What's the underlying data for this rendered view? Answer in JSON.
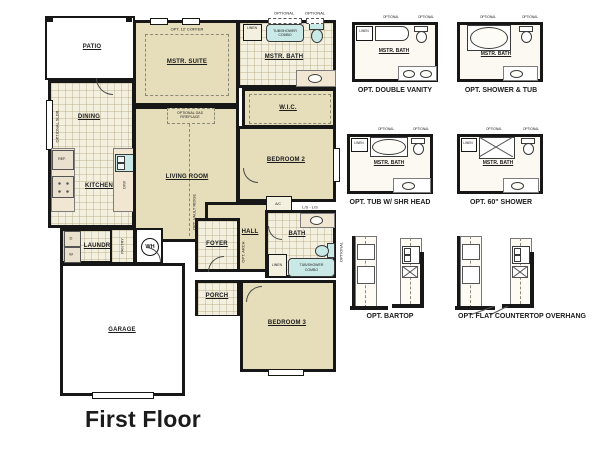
{
  "title": "First Floor",
  "colors": {
    "wall": "#171717",
    "room_beige": "#e6ddbb",
    "tile_cream": "#f4f0df",
    "fixture_blue": "#c9e9e7",
    "background": "#ffffff"
  },
  "plan": {
    "patio": "PATIO",
    "mstr_suite": "MSTR. SUITE",
    "coffer": "OPT. 12' COFFER",
    "mstr_bath": "MSTR. BATH",
    "tub_combo": "TUB/SHOWER COMBO",
    "optional": "OPTIONAL",
    "linen": "LINEN",
    "wic": "W.I.C.",
    "dining": "DINING",
    "sldr": "OPTIONAL SLDR.",
    "kitchen": "KITCHEN",
    "ref": "REF.",
    "dw": "D/W",
    "living": "LIVING ROOM",
    "fireplace": "OPTIONAL GAS FIREPLACE",
    "vault": "OPT. VAULT RIDGE",
    "bedroom2": "BEDROOM 2",
    "ac": "A/C",
    "ls": "L/S - L/S",
    "hall": "HALL",
    "bath": "BATH",
    "laundry": "LAUNDRY",
    "dryer": "D",
    "washer": "W",
    "pantry": "PANTRY",
    "wh": "WH",
    "foyer": "FOYER",
    "opt_arch": "OPT. ARCH",
    "porch": "PORCH",
    "garage": "GARAGE",
    "bedroom3": "BEDROOM 3"
  },
  "options": [
    {
      "caption": "OPT. DOUBLE VANITY",
      "room": "MSTR. BATH",
      "linen": "LINEN",
      "optional": "OPTIONAL"
    },
    {
      "caption": "OPT. SHOWER & TUB",
      "room": "MSTR. BATH",
      "optional": "OPTIONAL"
    },
    {
      "caption": "OPT. TUB W/ SHR HEAD",
      "room": "MSTR. BATH",
      "linen": "LINEN",
      "optional": "OPTIONAL"
    },
    {
      "caption": "OPT. 60\" SHOWER",
      "room": "MSTR. BATH",
      "linen": "LINEN",
      "optional": "OPTIONAL"
    },
    {
      "caption": "OPT. BARTOP"
    },
    {
      "caption": "OPT. FLAT COUNTERTOP OVERHANG"
    }
  ]
}
